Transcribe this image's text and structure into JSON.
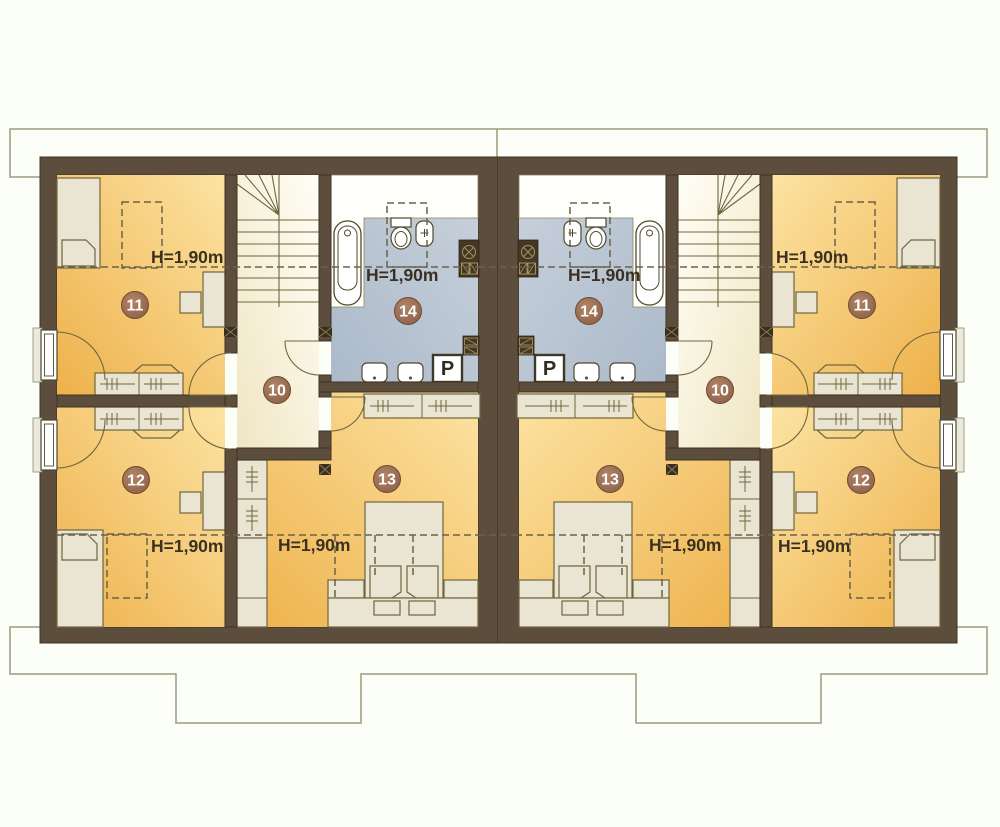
{
  "floor_plan": {
    "height_label": "H=1,90m",
    "washer_label": "P",
    "units": {
      "left": {
        "rooms": [
          {
            "number": "10"
          },
          {
            "number": "11"
          },
          {
            "number": "12"
          },
          {
            "number": "13"
          },
          {
            "number": "14"
          }
        ]
      },
      "right": {
        "rooms": [
          {
            "number": "10"
          },
          {
            "number": "11"
          },
          {
            "number": "12"
          },
          {
            "number": "13"
          },
          {
            "number": "14"
          }
        ]
      }
    },
    "colors": {
      "wall": "#5d4d3c",
      "room_floor_deep": "#eeb14b",
      "room_floor_light": "#fce3a2",
      "hallway_floor": "#fffef6",
      "bathroom_floor": "#b7c3d1",
      "furniture": "#eae4d2",
      "room_badge": "#9b7157",
      "label_text": "#3a3120",
      "eaves_outline": "#9c9c7c"
    }
  }
}
